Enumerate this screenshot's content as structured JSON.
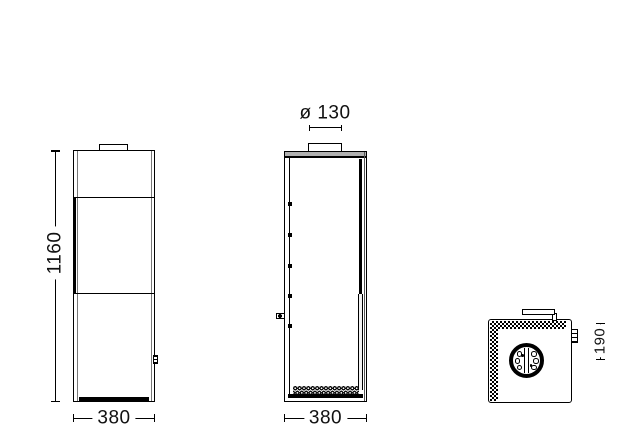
{
  "colors": {
    "background": "#ffffff",
    "line": "#000000",
    "top_band_fill": "#b0b0b0"
  },
  "views": {
    "front": {
      "dims": {
        "height": "1160",
        "width": "380"
      }
    },
    "side": {
      "dims": {
        "flue_diameter": "ø 130",
        "depth": "380"
      }
    },
    "top": {
      "dims": {
        "flue_center_offset": "190"
      }
    }
  }
}
